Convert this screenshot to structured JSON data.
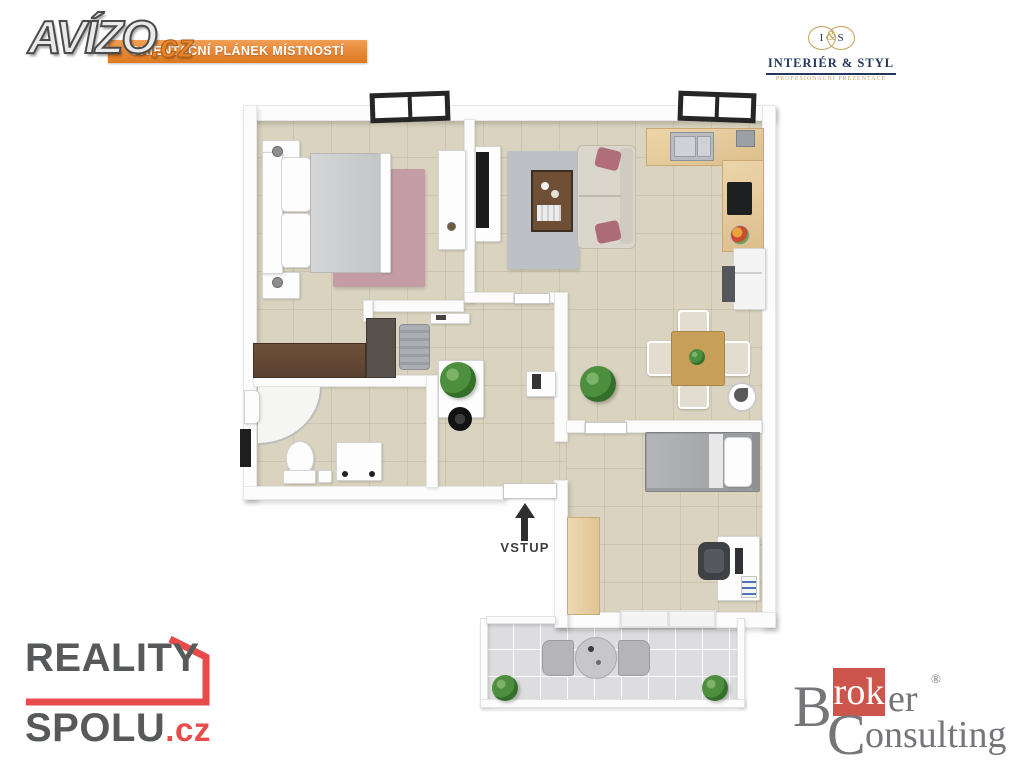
{
  "avizo": {
    "name": "AVÍZO",
    "tld": ".cz"
  },
  "banner": {
    "text": "ORIENTAČNÍ PLÁNEK MÍSTNOSTÍ"
  },
  "interier_styl": {
    "monogram_i": "I",
    "monogram_amp": "&",
    "monogram_s": "S",
    "title": "INTERIÉR & STYL",
    "subtitle": "PROFESIONÁLNÍ PREZENTACE"
  },
  "plan": {
    "entrance_label": "VSTUP"
  },
  "reality_spolu": {
    "line1": "REALITY",
    "line2": "SPOLU",
    "tld": ".cz"
  },
  "broker": {
    "initial1": "B",
    "highlight": "rok",
    "tail1": "er",
    "registered": "®",
    "initial2": "C",
    "tail2": "onsulting"
  },
  "colors": {
    "banner-orange": "#E8893B",
    "banner-orange-dark": "#DE7A1F",
    "avizo-orange": "#E8832C",
    "accent-red": "#E84B4B",
    "logo-gray": "#58595B",
    "broker-red": "#CC564B",
    "broker-gray": "#75767A",
    "gold": "#C2A35B",
    "navy": "#25355B",
    "floor-beige": "#D9D3BF",
    "balcony-gray": "#DDDDDF",
    "wall-white": "#FCFCFC",
    "arrow-dark": "#2E2E2E"
  }
}
